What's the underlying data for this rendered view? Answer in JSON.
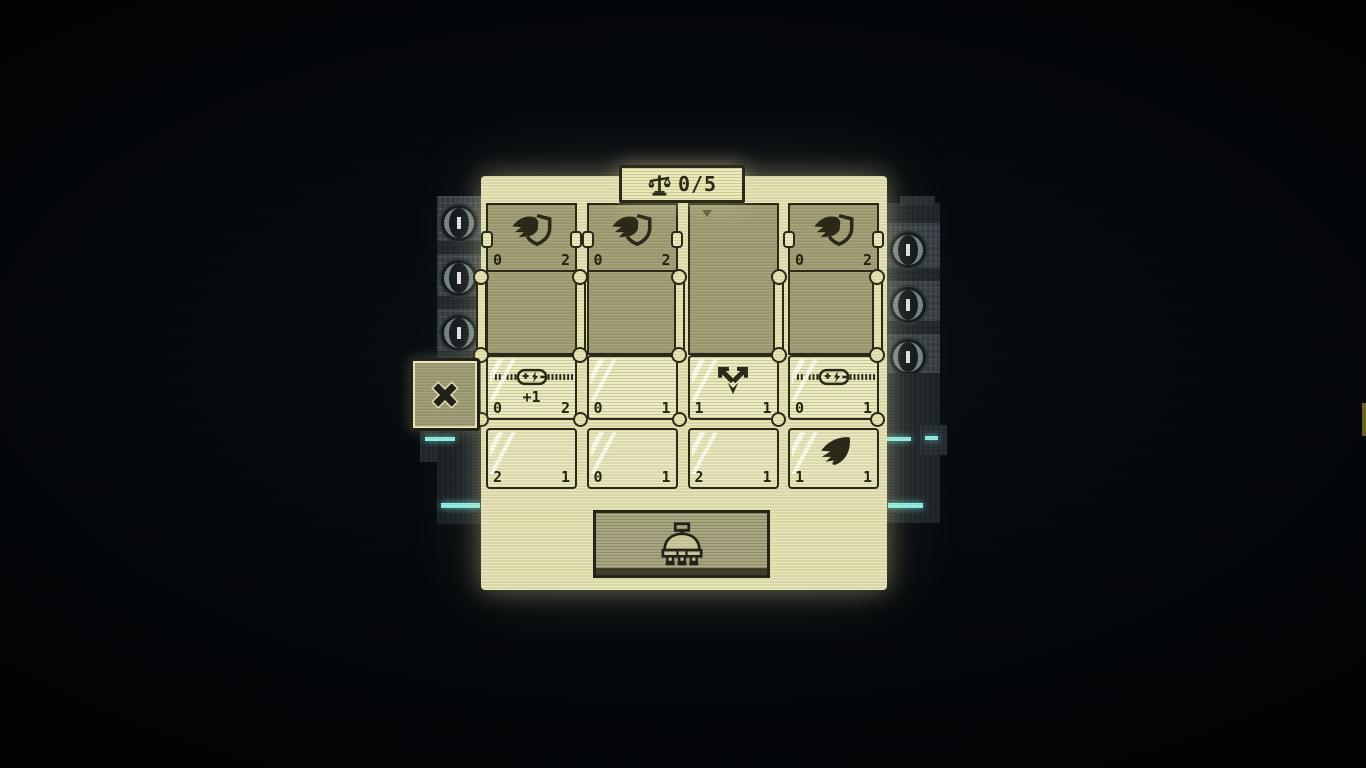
{
  "counter": {
    "icon": "scales",
    "value": "0/5"
  },
  "close_button": {
    "icon": "x"
  },
  "board": {
    "columns": [
      {
        "top_card": {
          "present": true,
          "icon": "winged-shield",
          "left": "0",
          "right": "2"
        },
        "mid_card": {
          "icon": "power-slider",
          "bonus": "+1",
          "left": "0",
          "right": "2"
        },
        "bottom_card": {
          "icon": "",
          "left": "2",
          "right": "1"
        }
      },
      {
        "top_card": {
          "present": true,
          "icon": "winged-shield",
          "left": "0",
          "right": "2"
        },
        "mid_card": {
          "icon": "",
          "bonus": "",
          "left": "0",
          "right": "1"
        },
        "bottom_card": {
          "icon": "",
          "left": "0",
          "right": "1"
        }
      },
      {
        "top_card": {
          "present": false,
          "icon": "",
          "left": "",
          "right": ""
        },
        "mid_card": {
          "icon": "split-arrows",
          "bonus": "",
          "left": "1",
          "right": "1"
        },
        "bottom_card": {
          "icon": "",
          "left": "2",
          "right": "1"
        }
      },
      {
        "top_card": {
          "present": true,
          "icon": "winged-shield",
          "left": "0",
          "right": "2"
        },
        "mid_card": {
          "icon": "power-slider",
          "bonus": "",
          "left": "0",
          "right": "1"
        },
        "bottom_card": {
          "icon": "wing",
          "left": "1",
          "right": "1"
        }
      }
    ]
  },
  "dock": {
    "icon": "robot-dome"
  },
  "colors": {
    "background": "#05080d",
    "panel_cream": "#eae7ba",
    "card_light": "#edebc0",
    "socket_khaki": "#a8a57c",
    "ink_dark": "#2c2b19",
    "machine_gray": "#39424a",
    "glow_cyan": "#8ef0ea"
  }
}
